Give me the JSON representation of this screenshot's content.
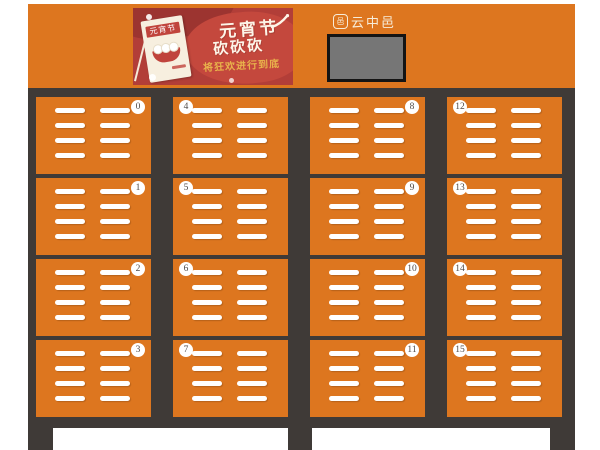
{
  "theme": {
    "page_bg": "#ffffff",
    "orange": "#dd761f",
    "frame_dark": "#3f3a37",
    "slat_white": "#ffffff",
    "badge_bg": "#ffffff",
    "badge_text": "#4f4a47",
    "banner_red": "#b23e38",
    "banner_red_light": "#c4483d",
    "banner_red_dark": "#9c3430",
    "banner_gold": "#e8b24b",
    "calendar_paper": "#f7efdf",
    "calendar_red": "#c0443c",
    "screen_gray": "#767676",
    "screen_border": "#141414",
    "brand_text": "#f7ecd9"
  },
  "header": {
    "banner": {
      "headline": "元宵节",
      "headline2": "砍砍砍",
      "tagline": "将狂欢进行到底",
      "calendar_title": "元宵节"
    },
    "brand": {
      "icon_glyph": "邑",
      "name": "云中邑"
    }
  },
  "cabinet": {
    "doors": [
      {
        "number": "0",
        "badge_side": "right"
      },
      {
        "number": "4",
        "badge_side": "left"
      },
      {
        "number": "8",
        "badge_side": "right"
      },
      {
        "number": "12",
        "badge_side": "left"
      },
      {
        "number": "1",
        "badge_side": "right"
      },
      {
        "number": "5",
        "badge_side": "left"
      },
      {
        "number": "9",
        "badge_side": "right"
      },
      {
        "number": "13",
        "badge_side": "left"
      },
      {
        "number": "2",
        "badge_side": "right"
      },
      {
        "number": "6",
        "badge_side": "left"
      },
      {
        "number": "10",
        "badge_side": "right"
      },
      {
        "number": "14",
        "badge_side": "left"
      },
      {
        "number": "3",
        "badge_side": "right"
      },
      {
        "number": "7",
        "badge_side": "left"
      },
      {
        "number": "11",
        "badge_side": "right"
      },
      {
        "number": "15",
        "badge_side": "left"
      }
    ]
  }
}
